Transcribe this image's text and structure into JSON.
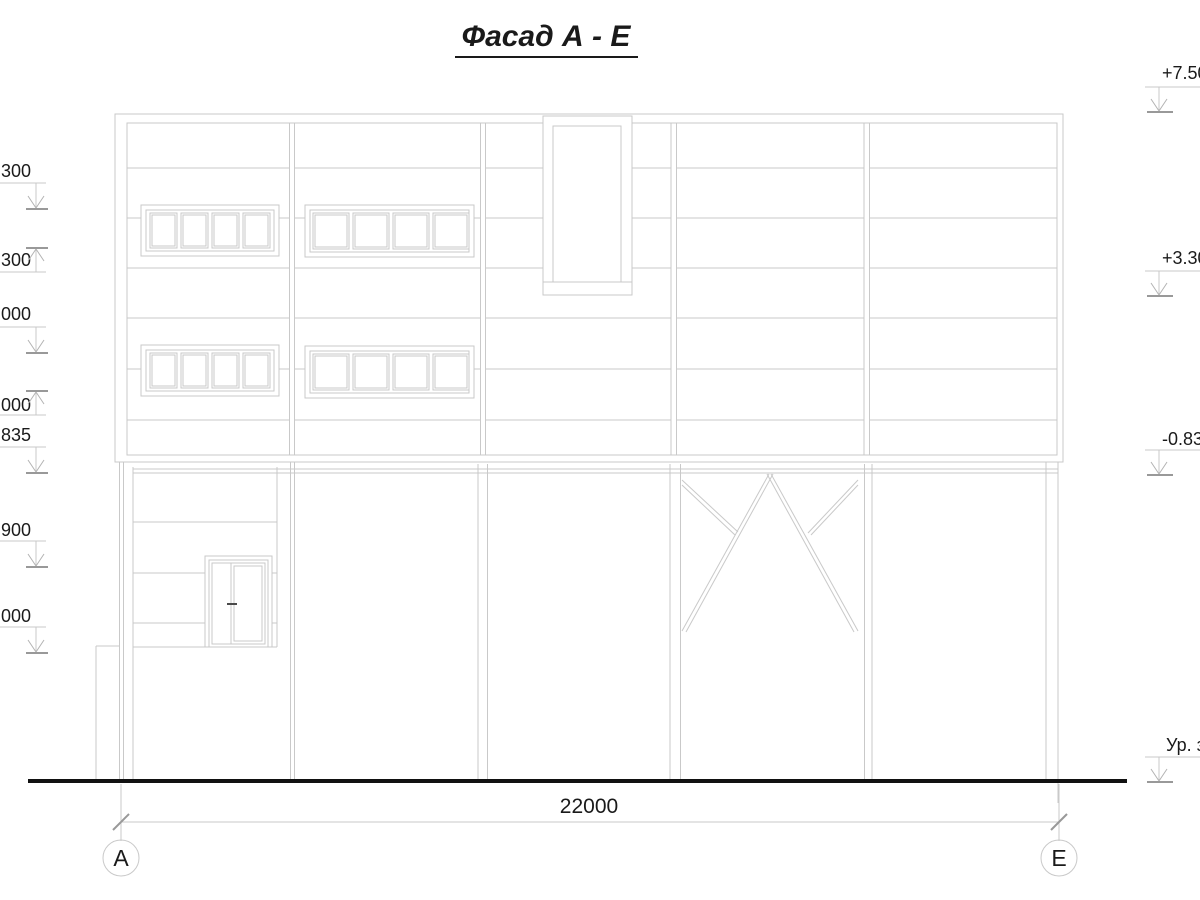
{
  "drawing": {
    "title": "Фасад А - Е",
    "dimension_label": "22000",
    "axis_left": "А",
    "axis_right": "Е",
    "elevation_marks_left": [
      "300",
      ".300",
      "000",
      "000",
      ".835",
      ".900",
      ".000"
    ],
    "elevation_marks_right": [
      "+7.500",
      "+3.300",
      "-0.835",
      "Ур. з."
    ],
    "colors": {
      "line": "#c9c9c9",
      "tick": "#999999",
      "text": "#1a1a1a",
      "ground": "#111111"
    }
  }
}
